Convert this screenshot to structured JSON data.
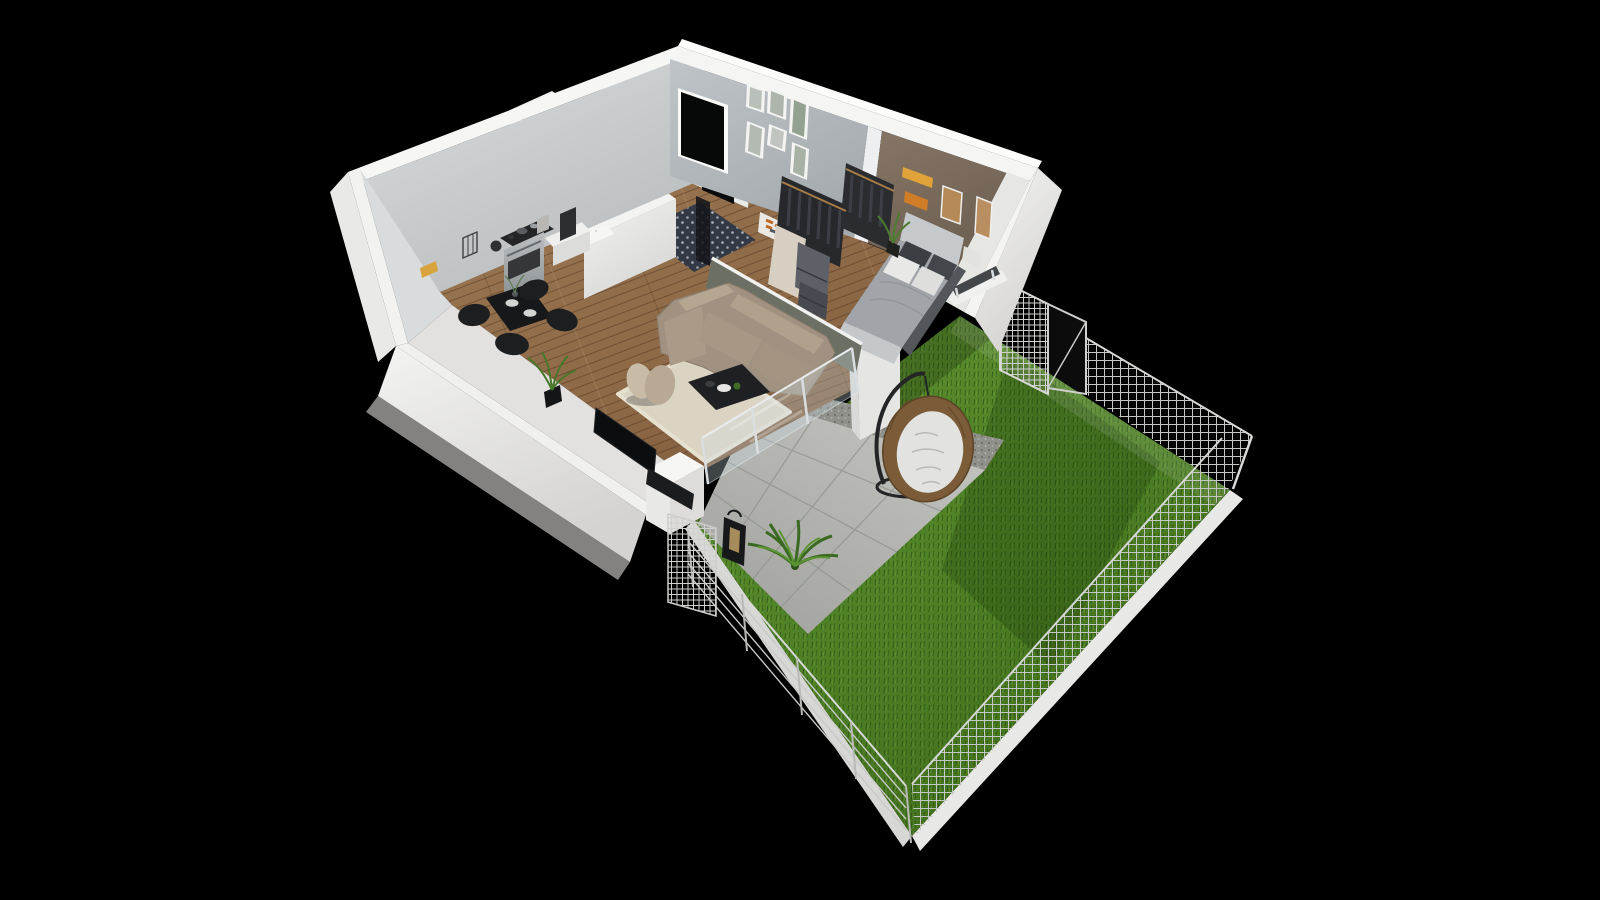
{
  "scene": {
    "type": "3d-apartment-floor-plan-render",
    "view": "isometric-birdseye",
    "background": "#000000",
    "palette": {
      "wall_top": "#f6f6f4",
      "wall_outer": "#e9e9e7",
      "wall_inner": "#c6c9cb",
      "gallery_wall": "#b5bbbf",
      "accent_wall": "#7a6c5e",
      "cream_wall": "#d6cfc2",
      "olive_wall": "#6c7064",
      "tile_white": "#ecefee",
      "bath_floor": "#333a46",
      "wood_floor": "#8c6846",
      "terrace_tile": "#b1b2ae",
      "gravel": "#8f908a",
      "grass": "#4f8226",
      "grass_shadow": "#2c4f12",
      "curb": "#e8e8e6",
      "fence": "#c6c7c3",
      "glass": "#cddde3",
      "sofa": "#a09180",
      "sofa_cushion": "#b5a692",
      "rug": "#dbd4c3",
      "coffee_table": "#1f2023",
      "lounge_chair": "#c8bca7",
      "tv": "#0c0d0f",
      "dining_set": "#17181a",
      "bed_duvet": "#a1a5a9",
      "bed_headboard": "#c6c9cc",
      "pillow_dark": "#3b3f44",
      "pillow_light": "#e8e8e6",
      "wardrobe": "#26282c",
      "drawer_unit": "#5d6167",
      "art_orange": "#cf7d26",
      "egg_chair_rattan": "#7b5b38",
      "egg_chair_cushion": "#e2e2e0",
      "plant_green": "#47782b",
      "lantern": "#17181a",
      "stove_steel": "#9fa4a8"
    },
    "rooms": [
      {
        "id": "kitchen-dining",
        "label": "Kitchen / Dining",
        "floor": "wood-planks",
        "items": [
          "yellow-wall-decor",
          "utensil-basket",
          "kettle",
          "stove-with-cooktop",
          "coffee-machine",
          "white-counter",
          "wall-mounted-table",
          "black-glass-dining-table",
          "dining-chairs-4",
          "potted-palm"
        ]
      },
      {
        "id": "bathroom",
        "label": "Bathroom",
        "floor": "patterned-tile",
        "items": [
          "white-subway-tile-walls",
          "walk-in-shower",
          "shower-glass-panel",
          "half-wall"
        ]
      },
      {
        "id": "hallway",
        "label": "Hallway",
        "floor": "wood-planks",
        "items": [
          "entry-door",
          "gallery-wall-6-frames",
          "console-shelf-with-books"
        ]
      },
      {
        "id": "living-room",
        "label": "Living room",
        "floor": "wood-planks",
        "items": [
          "beige-corner-sofa",
          "cream-area-rug",
          "black-coffee-table",
          "petal-lounge-chair",
          "wall-tv",
          "media-console",
          "glass-balustrade-to-terrace"
        ]
      },
      {
        "id": "bedroom",
        "label": "Bedroom",
        "floor": "wood-planks",
        "items": [
          "gray-double-bed",
          "headboard",
          "dark-patterned-pillows",
          "white-patterned-pillows",
          "open-wardrobe-racks",
          "drawer-units",
          "potted-plant",
          "window-to-garden",
          "accent-wall-artworks-4"
        ]
      },
      {
        "id": "terrace",
        "label": "Terrace",
        "floor": "concrete-tiles",
        "items": [
          "hanging-egg-chair",
          "palm-plant",
          "candle-lantern",
          "gravel-strip"
        ]
      },
      {
        "id": "garden",
        "label": "Garden",
        "floor": "lawn",
        "items": [
          "grass-lawn",
          "mesh-fence-panels",
          "wire-rail-fence",
          "fence-gate",
          "concrete-curb"
        ]
      }
    ]
  }
}
